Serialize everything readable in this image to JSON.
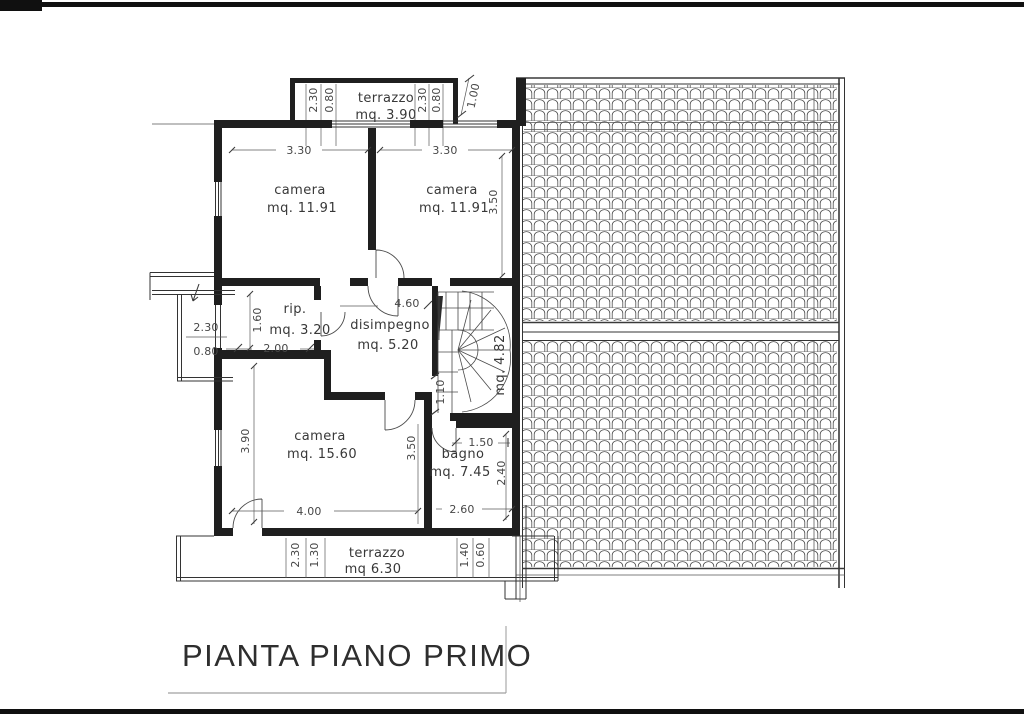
{
  "title": "PIANTA PIANO PRIMO",
  "rooms": {
    "terrazzo_top": {
      "name": "terrazzo",
      "area": "mq.  3.90"
    },
    "camera_tl": {
      "name": "camera",
      "area": "mq.  11.91"
    },
    "camera_tr": {
      "name": "camera",
      "area": "mq.  11.91"
    },
    "rip": {
      "name": "rip.",
      "area": "mq.  3.20"
    },
    "disimpegno": {
      "name": "disimpegno",
      "area": "mq.  5.20"
    },
    "scala": {
      "area": "mq. 4.82"
    },
    "camera_b": {
      "name": "camera",
      "area": "mq.  15.60"
    },
    "bagno": {
      "name": "bagno",
      "area": "mq.  7.45"
    },
    "terrazzo_bottom": {
      "name": "terrazzo",
      "area": "mq  6.30"
    }
  },
  "dims": {
    "t_top_left_w": "2.30",
    "t_top_left_d": "0.80",
    "t_top_right_w": "2.30",
    "t_top_right_d": "0.80",
    "t_top_diag": "1.00",
    "cam_tl_w": "3.30",
    "cam_tr_w": "3.30",
    "cam_tr_h": "3.50",
    "rip_h": "1.60",
    "rip_w": "2.00",
    "balcony_w": "2.30",
    "balcony_d": "0.80",
    "dis_w": "4.60",
    "stair_pass": "1.10",
    "cam_b_h": "3.90",
    "cam_b_w": "4.00",
    "cam_b_div": "3.50",
    "bagno_pass": "1.50",
    "bagno_h": "2.40",
    "bagno_w": "2.60",
    "t_bot_a": "2.30",
    "t_bot_b": "1.30",
    "t_bot_c": "1.40",
    "t_bot_d": "0.60"
  }
}
